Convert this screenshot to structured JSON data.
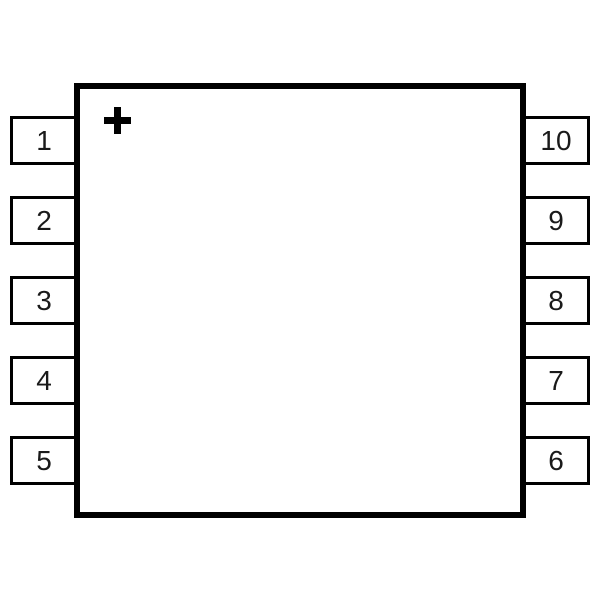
{
  "diagram": {
    "polarity_marker": "+",
    "line_color": "#000000",
    "fill_color": "#ffffff",
    "text_color": "#1a1a1a"
  },
  "chip": {
    "left_pins": [
      {
        "number": "1"
      },
      {
        "number": "2"
      },
      {
        "number": "3"
      },
      {
        "number": "4"
      },
      {
        "number": "5"
      }
    ],
    "right_pins": [
      {
        "number": "10"
      },
      {
        "number": "9"
      },
      {
        "number": "8"
      },
      {
        "number": "7"
      },
      {
        "number": "6"
      }
    ]
  }
}
